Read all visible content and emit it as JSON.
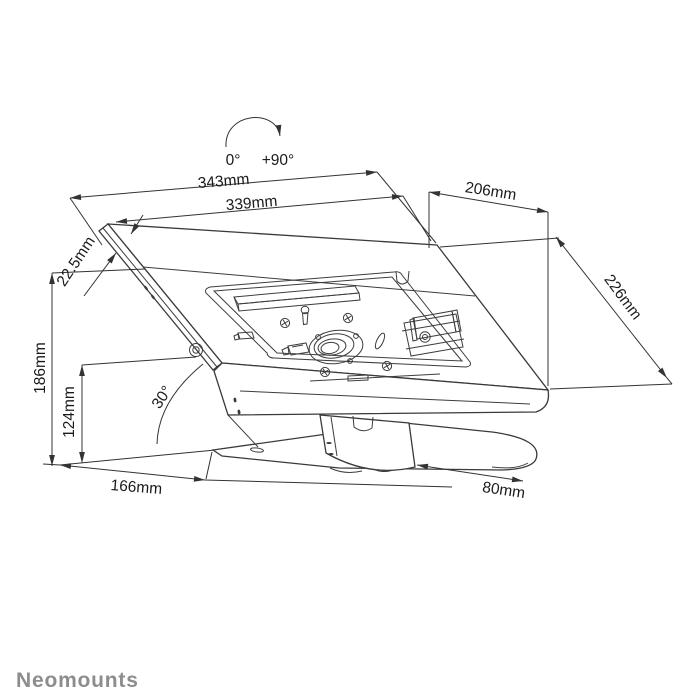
{
  "brand": {
    "logo_text": "Neomounts"
  },
  "rotation": {
    "start_label": "0°",
    "end_label": "+90°"
  },
  "dimensions": {
    "outer_width": "343mm",
    "inner_width": "339mm",
    "top_depth": "206mm",
    "side_depth": "226mm",
    "profile_thickness": "22.5mm",
    "total_height": "186mm",
    "pivot_height": "124mm",
    "base_depth": "166mm",
    "base_width": "80mm",
    "tilt_angle": "30°"
  },
  "colors": {
    "line": "#3a3a3a",
    "label_text": "#1a1a1a",
    "logo": "#8d8d8d",
    "background": "#ffffff"
  }
}
